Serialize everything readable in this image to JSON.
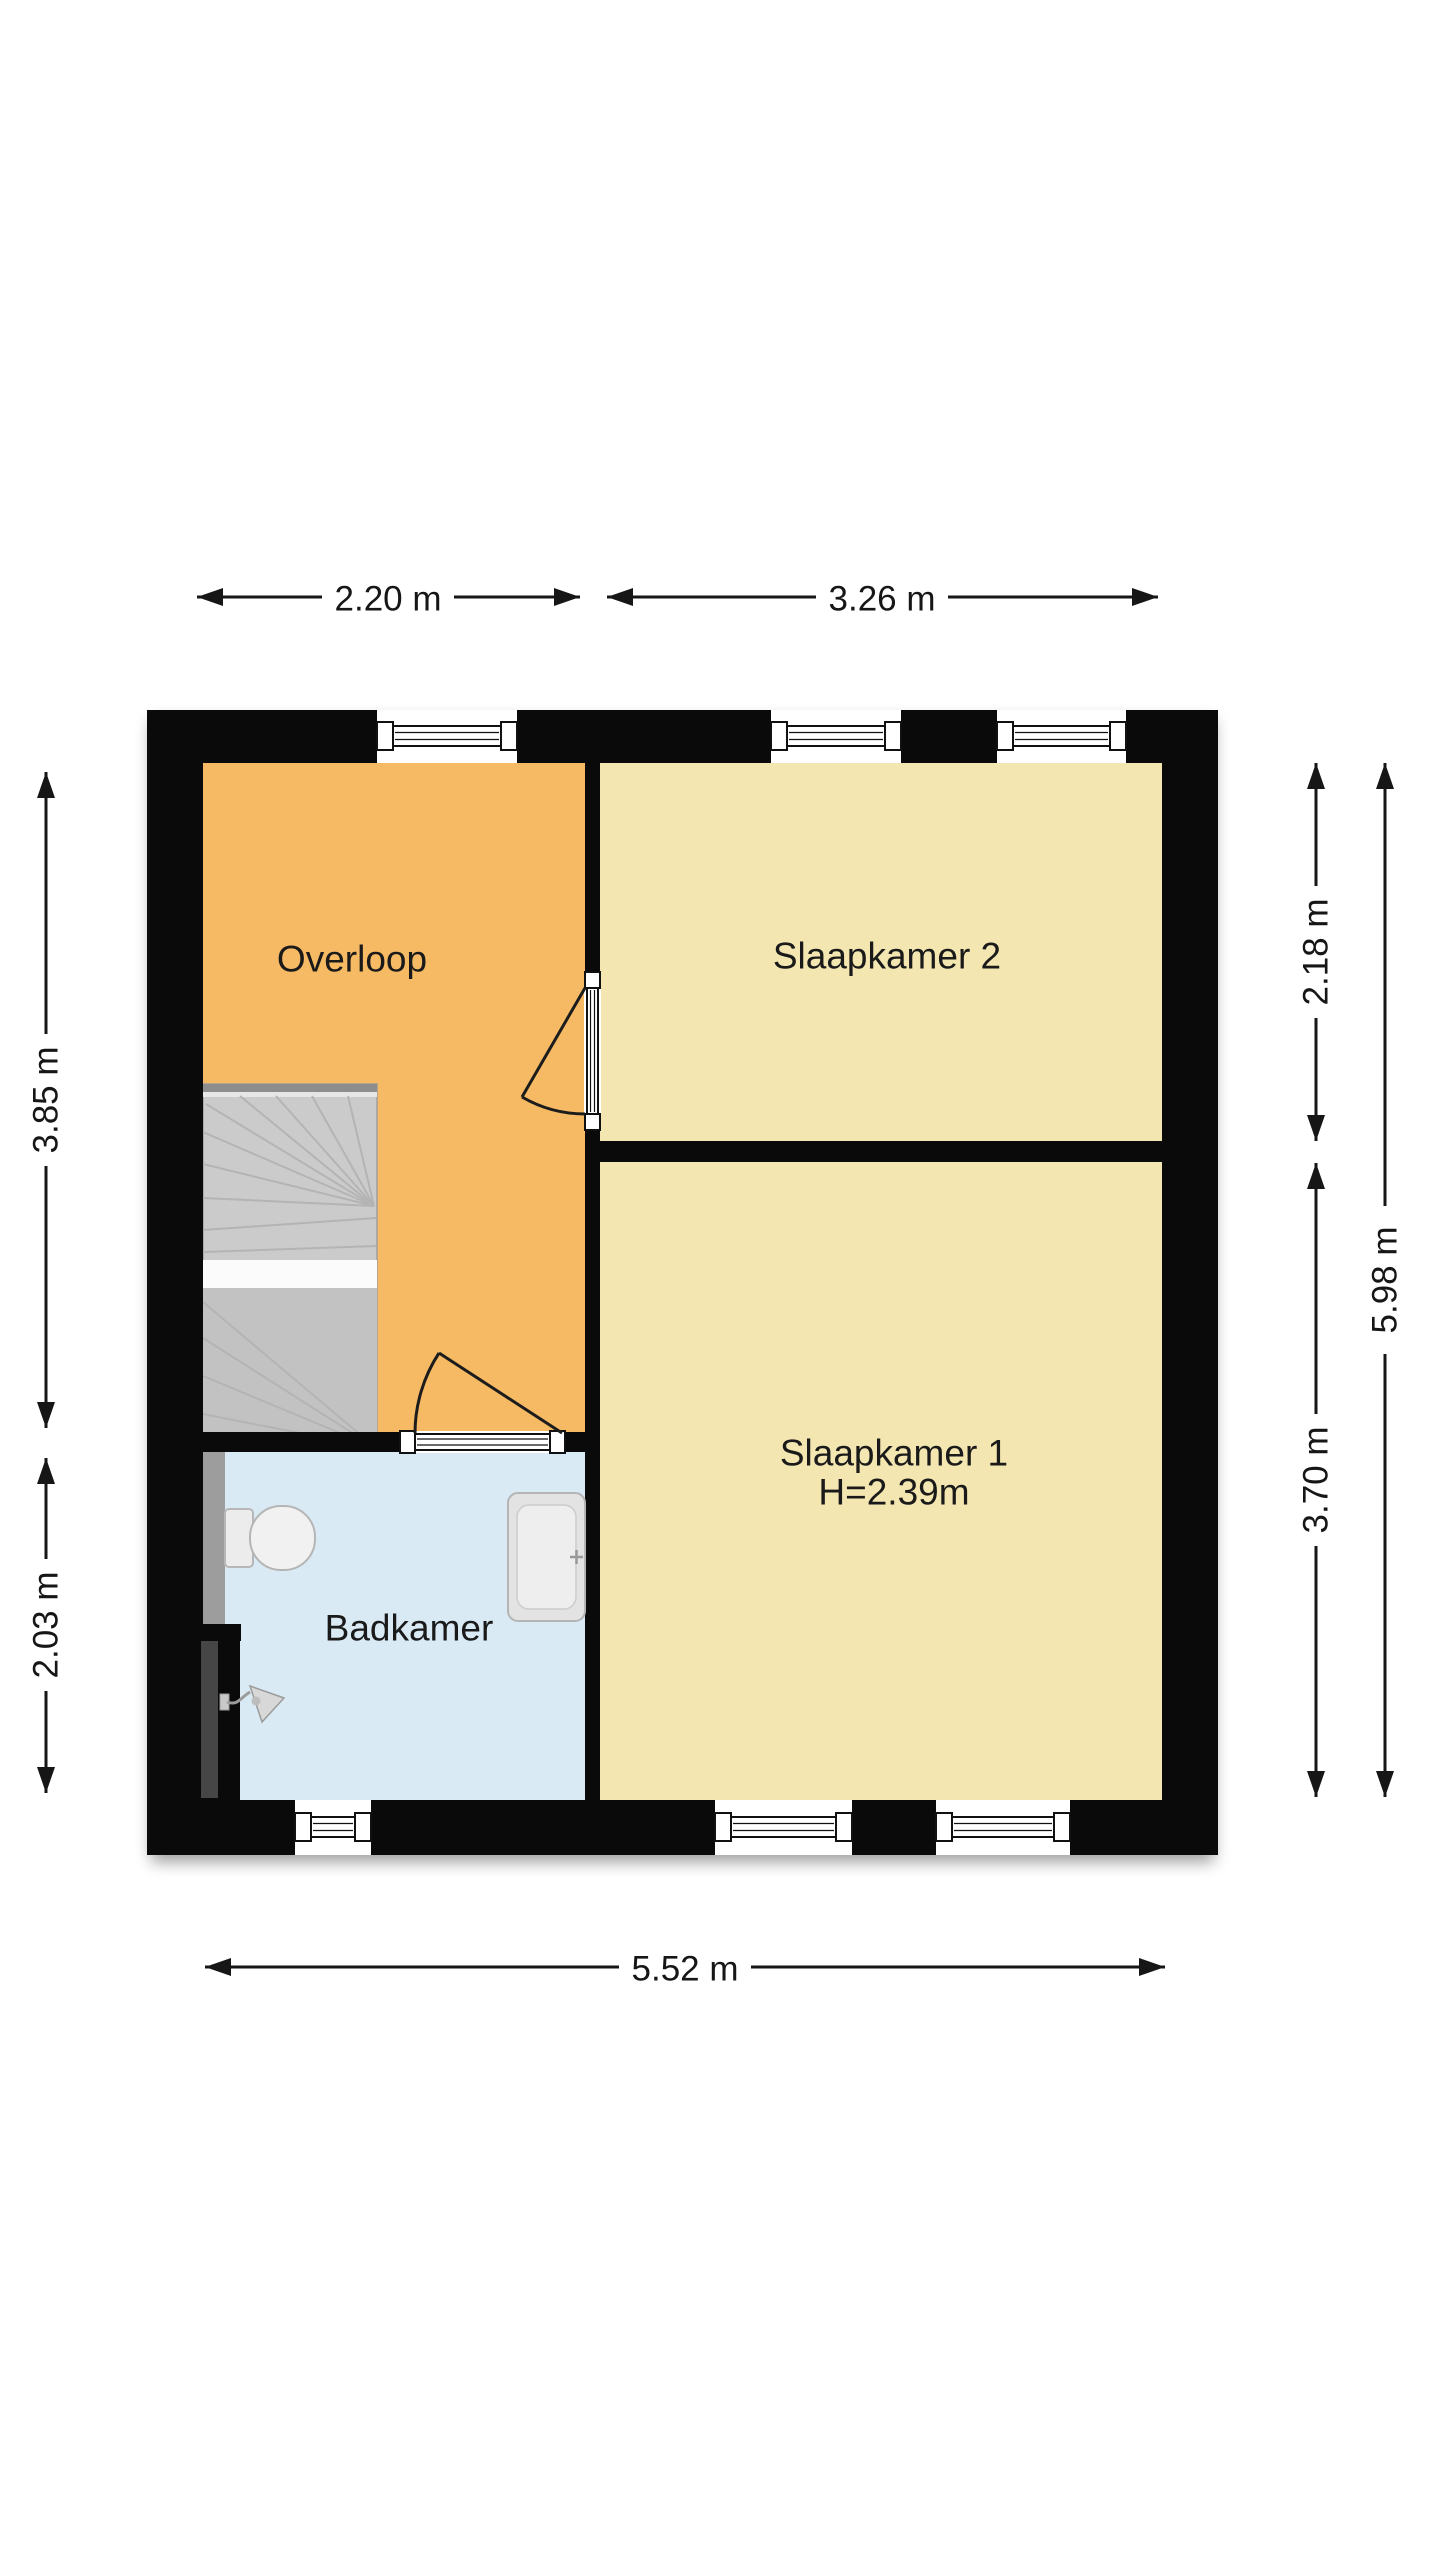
{
  "floorplan": {
    "rooms": [
      {
        "id": "overloop",
        "label": "Overloop",
        "floor_color": "#f6ba64"
      },
      {
        "id": "slaapkamer-2",
        "label": "Slaapkamer 2",
        "floor_color": "#f3e6b0"
      },
      {
        "id": "slaapkamer-1",
        "label": "Slaapkamer 1",
        "ceiling_height": "H=2.39m",
        "floor_color": "#f3e6b0"
      },
      {
        "id": "badkamer",
        "label": "Badkamer",
        "floor_color": "#d9eaf4"
      }
    ],
    "dimensions": [
      {
        "label": "2.20 m",
        "edge": "top"
      },
      {
        "label": "3.26 m",
        "edge": "top"
      },
      {
        "label": "5.52 m",
        "edge": "bottom"
      },
      {
        "label": "3.85 m",
        "edge": "left"
      },
      {
        "label": "2.03 m",
        "edge": "left"
      },
      {
        "label": "2.18 m",
        "edge": "right"
      },
      {
        "label": "3.70 m",
        "edge": "right"
      },
      {
        "label": "5.98 m",
        "edge": "right"
      }
    ],
    "fixtures": [
      "stairs",
      "toilet",
      "sink",
      "shower-head"
    ],
    "colors": {
      "walls": "#0a0a0a",
      "dimension_lines": "#161616",
      "stairs": "#cbcbcb",
      "duct": "#464646",
      "background": "#ffffff"
    }
  }
}
